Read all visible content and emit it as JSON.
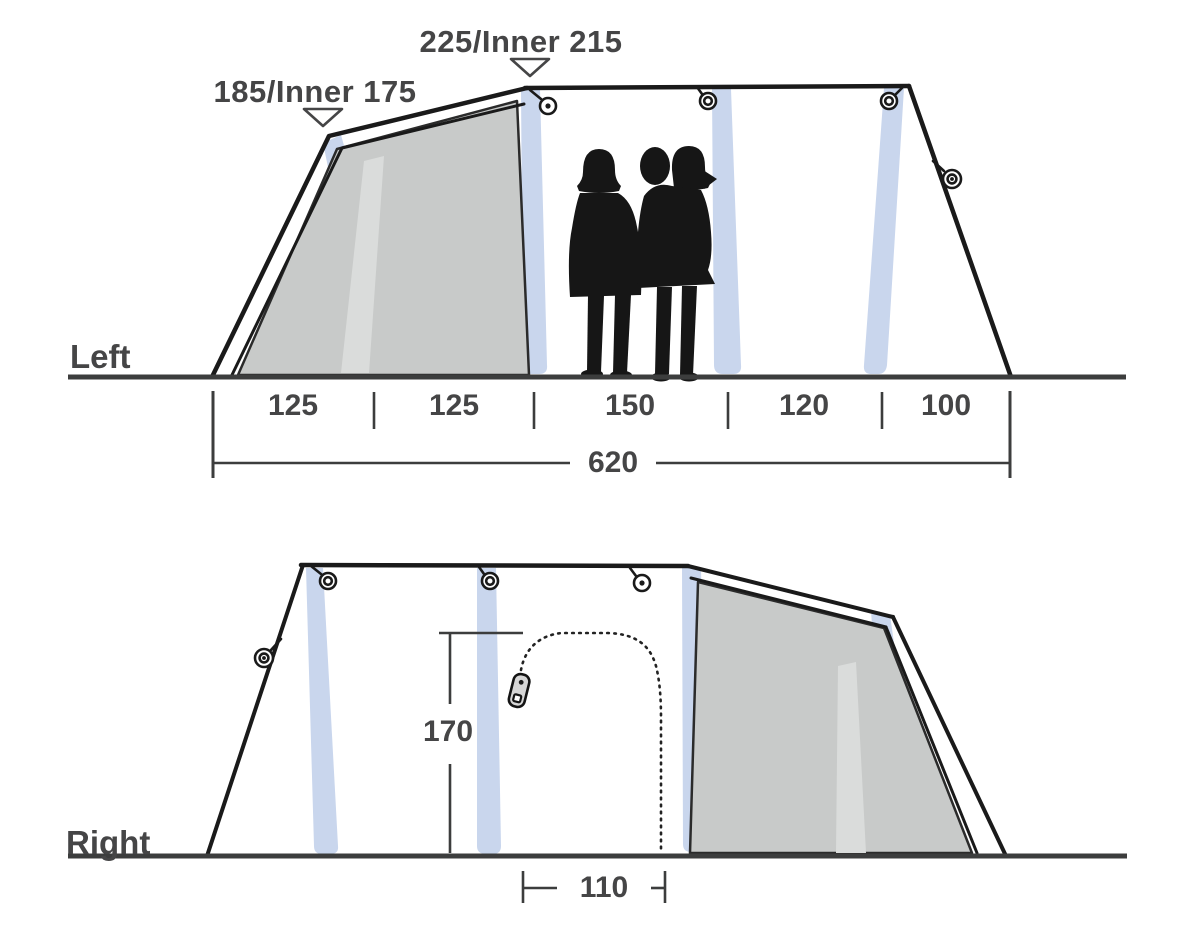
{
  "colors": {
    "outline": "#1a1a1a",
    "ground": "#3c3d3d",
    "text": "#454546",
    "beam": "#c9d6ed",
    "panel": "#c8cac9",
    "panel_stripe": "#dadcdb",
    "zipper": "#d6d6d6"
  },
  "left_view": {
    "label": "Left",
    "peak_height_label": "225/Inner 215",
    "front_height_label": "185/Inner 175",
    "segments": [
      "125",
      "125",
      "150",
      "120",
      "100"
    ],
    "total_length": "620"
  },
  "right_view": {
    "label": "Right",
    "door_height": "170",
    "door_width": "110"
  },
  "icons": {
    "guy_ring": "guyline-ring-icon",
    "zipper_pull": "zipper-pull-icon",
    "height_marker": "triangle-marker-icon"
  }
}
